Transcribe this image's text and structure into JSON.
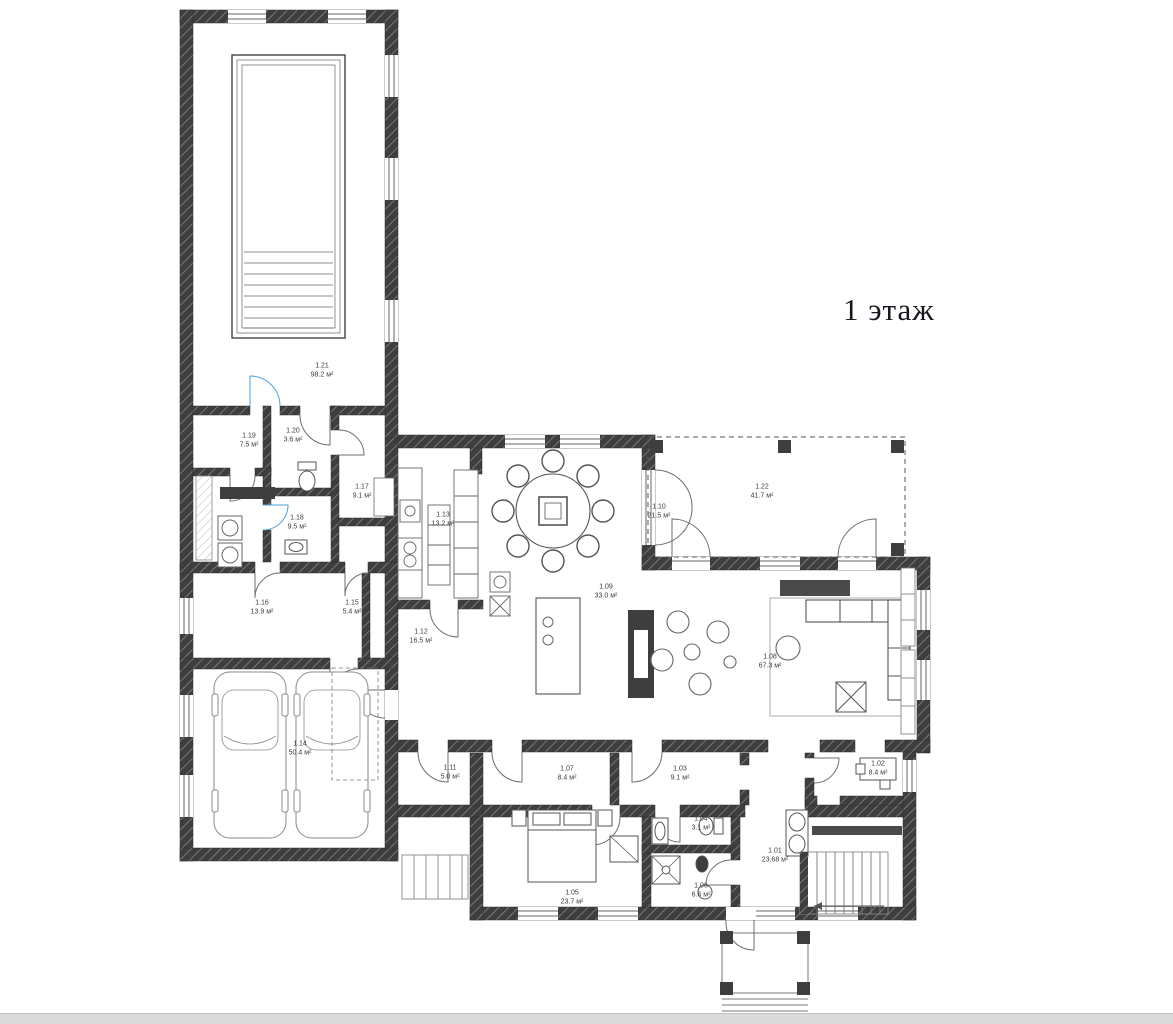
{
  "page": {
    "title": "1 этаж"
  },
  "plan": {
    "colors": {
      "wall": "#3e3e3e",
      "accent_blue": "#4aa3d8",
      "thin_line": "#777777"
    },
    "rooms": [
      {
        "number": "1.01",
        "area": "23.68 м²"
      },
      {
        "number": "1.02",
        "area": "8.4 м²"
      },
      {
        "number": "1.03",
        "area": "9.1 м²"
      },
      {
        "number": "1.04",
        "area": "3.1 м²"
      },
      {
        "number": "1.05",
        "area": "23.7 м²"
      },
      {
        "number": "1.06",
        "area": "6.6 м²"
      },
      {
        "number": "1.07",
        "area": "8.4 м²"
      },
      {
        "number": "1.08",
        "area": "67.3 м²"
      },
      {
        "number": "1.09",
        "area": "33.0 м²"
      },
      {
        "number": "1.10",
        "area": "21.5 м²"
      },
      {
        "number": "1.11",
        "area": "5.0 м²"
      },
      {
        "number": "1.12",
        "area": "16.5 м²"
      },
      {
        "number": "1.13",
        "area": "13.2 м²"
      },
      {
        "number": "1.14",
        "area": "50.4 м²"
      },
      {
        "number": "1.15",
        "area": "5.4 м²"
      },
      {
        "number": "1.16",
        "area": "13.9 м²"
      },
      {
        "number": "1.17",
        "area": "9.1 м²"
      },
      {
        "number": "1.18",
        "area": "9.5 м²"
      },
      {
        "number": "1.19",
        "area": "7.5 м²"
      },
      {
        "number": "1.20",
        "area": "3.6 м²"
      },
      {
        "number": "1.21",
        "area": "98.2 м²"
      },
      {
        "number": "1.22",
        "area": "41.7 м²"
      }
    ]
  }
}
